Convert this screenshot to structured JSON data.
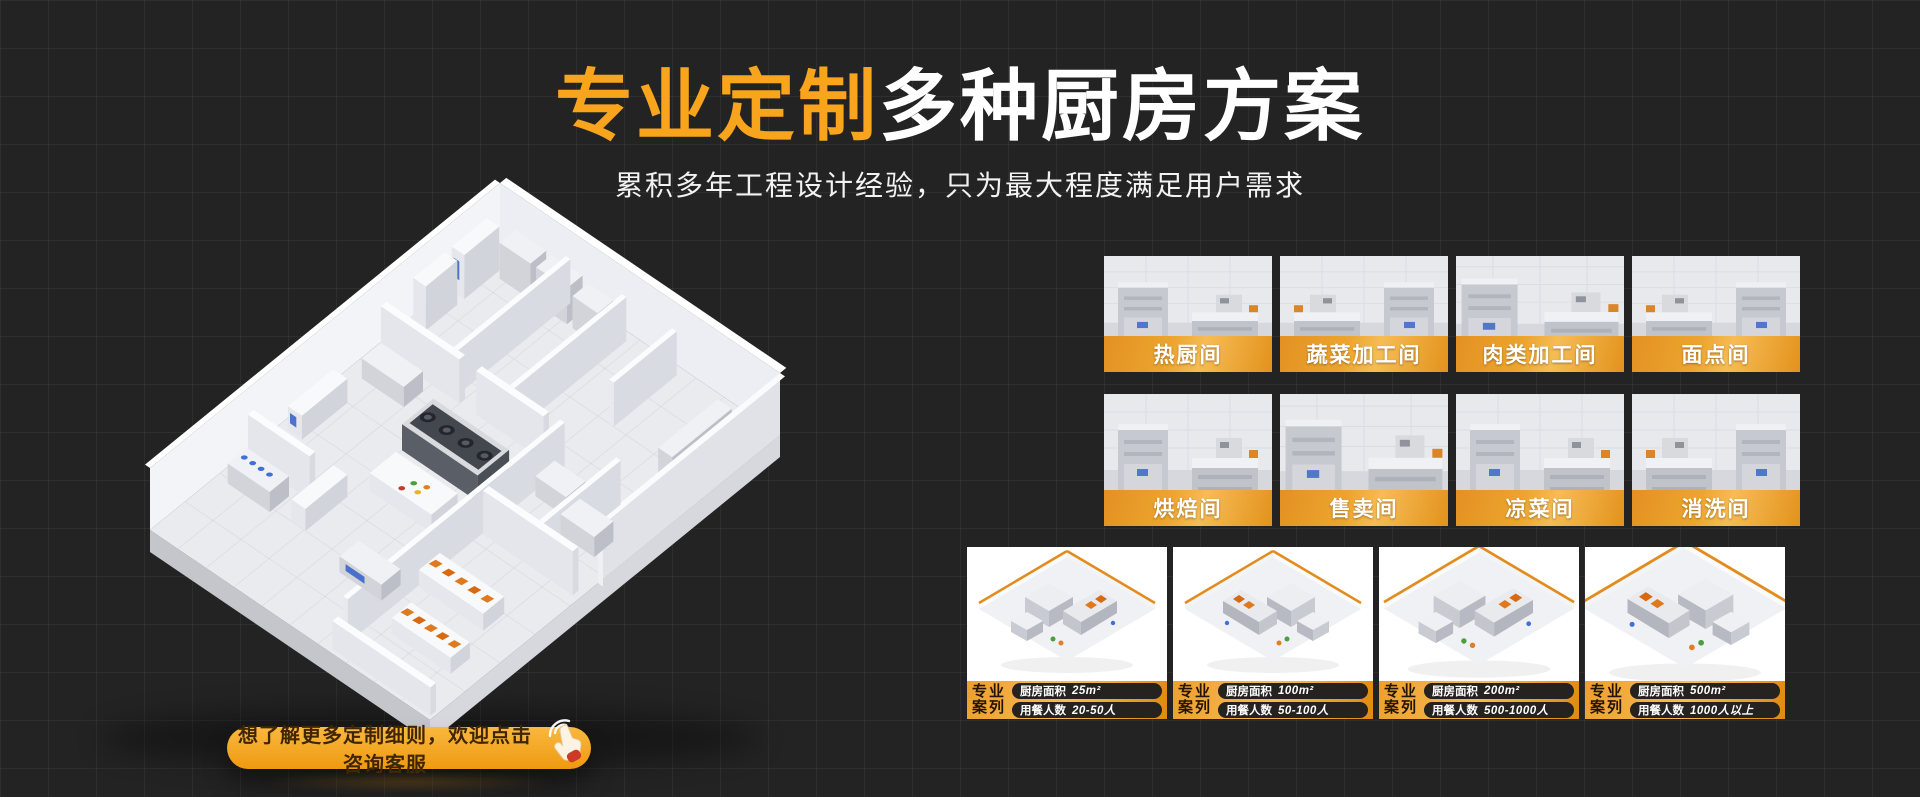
{
  "header": {
    "title_highlight": "专业定制",
    "title_rest": "多种厨房方案",
    "subtitle": "累积多年工程设计经验，只为最大程度满足用户需求"
  },
  "rooms": {
    "items": [
      {
        "label": "热厨间"
      },
      {
        "label": "蔬菜加工间"
      },
      {
        "label": "肉类加工间"
      },
      {
        "label": "面点间"
      },
      {
        "label": "烘焙间"
      },
      {
        "label": "售卖间"
      },
      {
        "label": "凉菜间"
      },
      {
        "label": "消洗间"
      }
    ]
  },
  "cases": {
    "tag_line1": "专业",
    "tag_line2": "案列",
    "area_label": "厨房面积",
    "diners_label": "用餐人数",
    "items": [
      {
        "area": "25m²",
        "diners": "20-50人"
      },
      {
        "area": "100m²",
        "diners": "50-100人"
      },
      {
        "area": "200m²",
        "diners": "500-1000人"
      },
      {
        "area": "500m²",
        "diners": "1000人以上"
      }
    ]
  },
  "cta": {
    "label": "想了解更多定制细则，欢迎点击咨询客服"
  },
  "icons": {
    "cta_hand": "click-hand"
  },
  "colors": {
    "bg": "#232323",
    "accent": "#f8a41d",
    "bar_from": "#e39122",
    "bar_to": "#e3921c",
    "case_from": "#eda02f",
    "case_to": "#e08a10",
    "pill_bg": "#262220",
    "cta_from": "#f9b83f",
    "cta_to": "#ef9a10",
    "cta_text": "#402600"
  }
}
